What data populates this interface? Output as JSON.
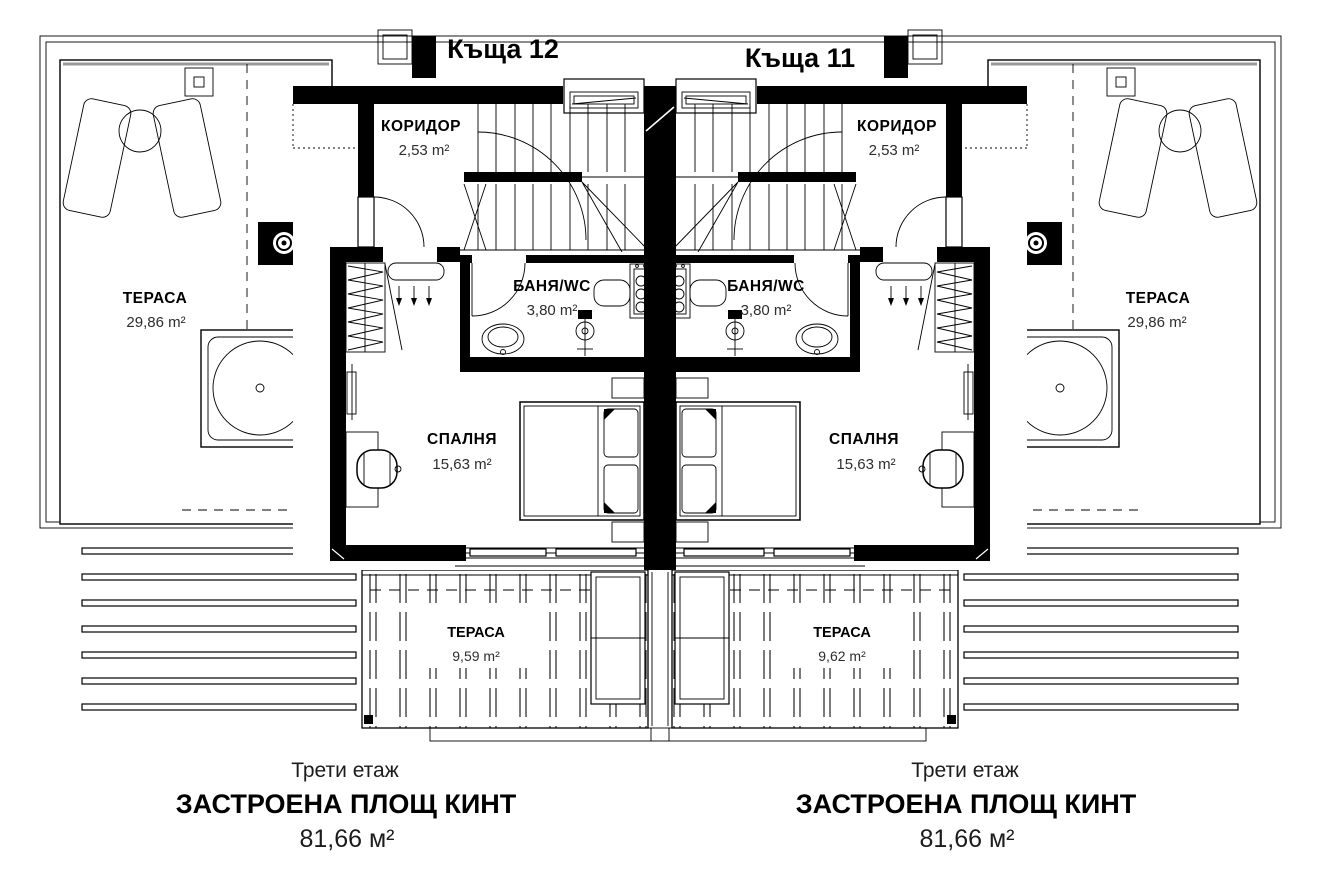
{
  "drawing": {
    "kind": "architectural floor plan, third floor of twin houses",
    "colors": {
      "ink": "#000000",
      "paper": "#ffffff",
      "accent_gray": "#999999"
    }
  },
  "houses": [
    {
      "title": "Къща 12",
      "rooms": {
        "corridor": {
          "name": "КОРИДОР",
          "area": "2,53 m²"
        },
        "bath": {
          "name": "БАНЯ/WC",
          "area": "3,80 m²"
        },
        "bedroom": {
          "name": "СПАЛНЯ",
          "area": "15,63 m²"
        },
        "terrace": {
          "name": "ТЕРАСА",
          "area": "29,86 m²"
        },
        "balcony": {
          "name": "ТЕРАСА",
          "area": "9,59 m²"
        }
      },
      "caption": {
        "floor": "Трети етаж",
        "label": "ЗАСТРОЕНА ПЛОЩ КИНТ",
        "area": "81,66 м²"
      }
    },
    {
      "title": "Къща 11",
      "rooms": {
        "corridor": {
          "name": "КОРИДОР",
          "area": "2,53 m²"
        },
        "bath": {
          "name": "БАНЯ/WC",
          "area": "3,80 m²"
        },
        "bedroom": {
          "name": "СПАЛНЯ",
          "area": "15,63 m²"
        },
        "terrace": {
          "name": "ТЕРАСА",
          "area": "29,86 m²"
        },
        "balcony": {
          "name": "ТЕРАСА",
          "area": "9,62 m²"
        }
      },
      "caption": {
        "floor": "Трети етаж",
        "label": "ЗАСТРОЕНА ПЛОЩ КИНТ",
        "area": "81,66 м²"
      }
    }
  ]
}
